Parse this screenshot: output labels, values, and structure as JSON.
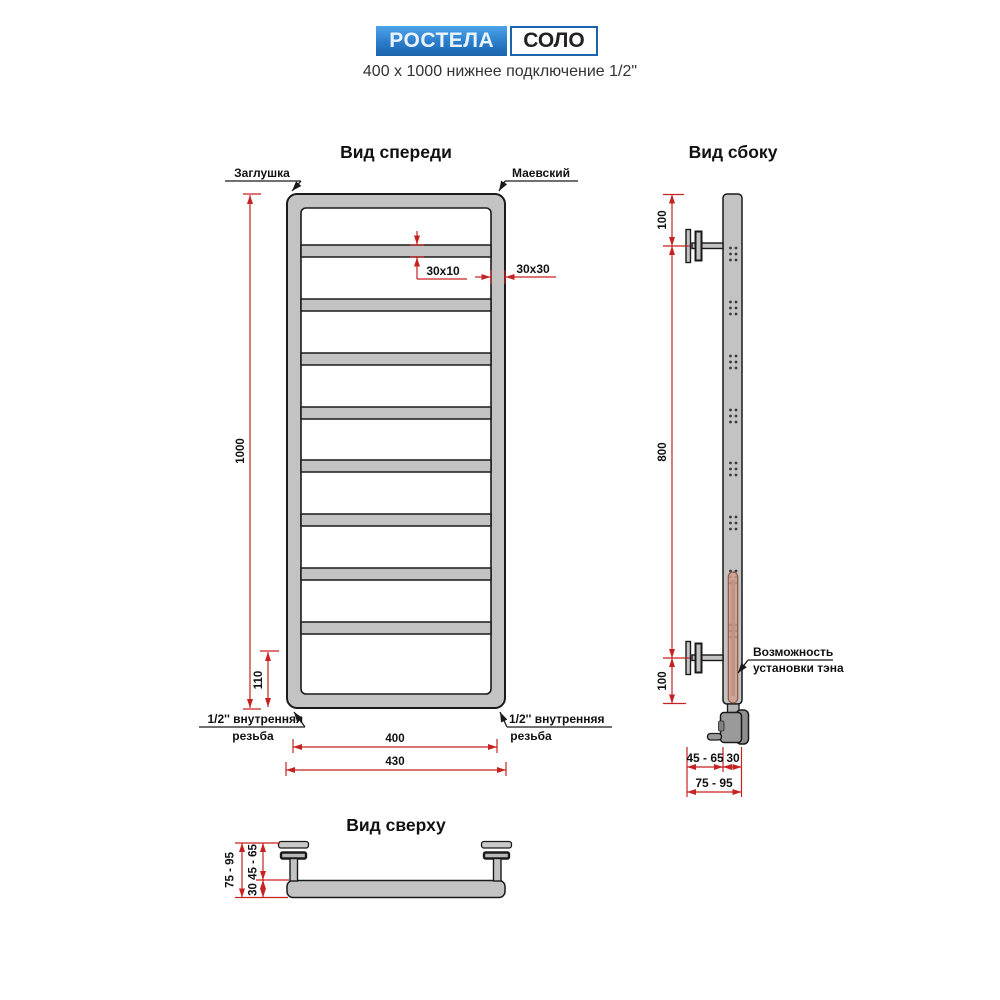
{
  "header": {
    "brand": "РОСТЕЛА",
    "model": "СОЛО",
    "subtitle": "400 x 1000 нижнее подключение 1/2\""
  },
  "front": {
    "title": "Вид спереди",
    "plug_label": "Заглушка",
    "valve_label": "Маевский",
    "thread_label_line1": "1/2'' внутренняя",
    "thread_label_line2": "резьба",
    "rung_count": 8,
    "dims": {
      "height": "1000",
      "bottom_gap": "110",
      "rung_profile": "30x10",
      "tube_profile": "30x30",
      "width_axes": "400",
      "width_overall": "430"
    }
  },
  "side": {
    "title": "Вид сбоку",
    "heater_label_line1": "Возможность",
    "heater_label_line2": "установки тэна",
    "dims": {
      "top_offset": "100",
      "bracket_span": "800",
      "bottom_offset": "100",
      "wall_to_tube": "45 - 65",
      "tube_depth": "30",
      "wall_total": "75 - 95"
    }
  },
  "top": {
    "title": "Вид сверху",
    "dims": {
      "wall_total": "75 - 95",
      "wall_to_tube": "45 - 65",
      "tube_depth": "30"
    }
  },
  "colors": {
    "dimension_red": "#c62222",
    "tube_gray": "#c3c3c3",
    "outline": "#1a1a1a",
    "brand_blue": "#1b63ad",
    "heater_tan": "#cf9d8c"
  }
}
